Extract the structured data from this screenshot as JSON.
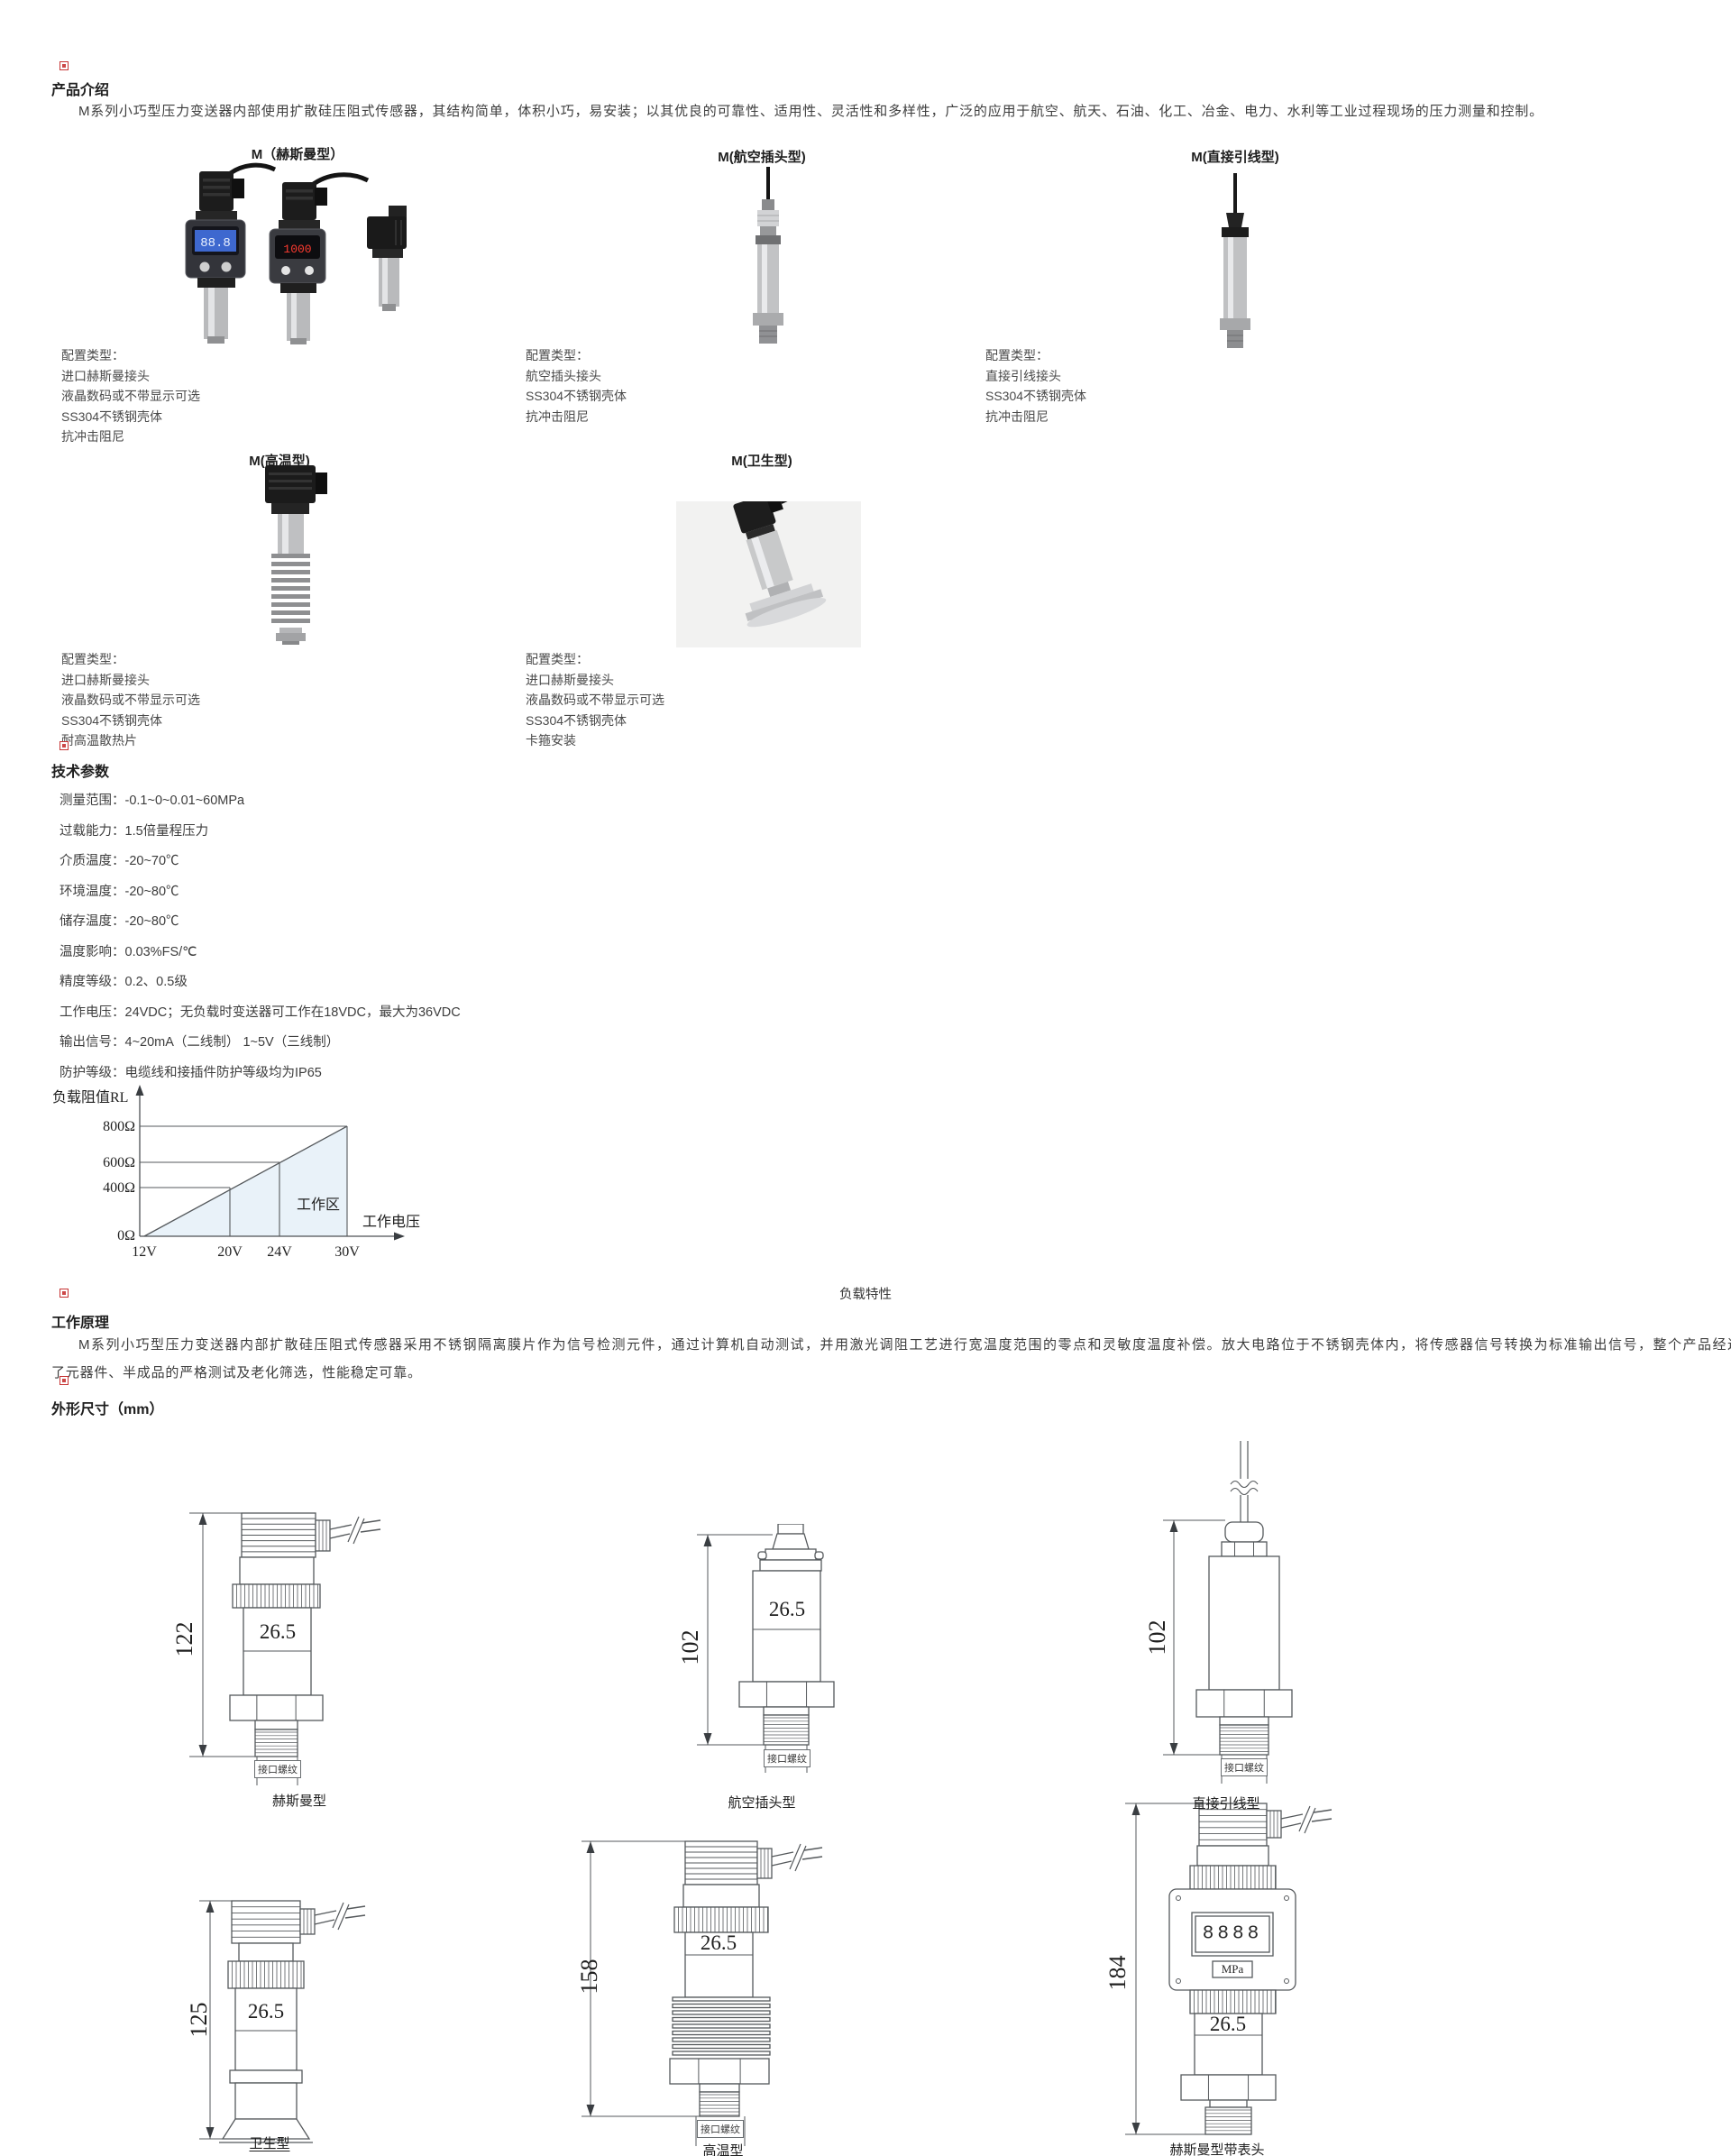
{
  "intro": {
    "header": "产品介绍",
    "text": "M系列小巧型压力变送器内部使用扩散硅压阻式传感器，其结构简单，体积小巧，易安装；以其优良的可靠性、适用性、灵活性和多样性，广泛的应用于航空、航天、石油、化工、冶金、电力、水利等工业过程现场的压力测量和控制。"
  },
  "products": [
    {
      "title": "M（赫斯曼型）",
      "config": [
        "配置类型：",
        "进口赫斯曼接头",
        "液晶数码或不带显示可选",
        "SS304不锈钢壳体",
        "抗冲击阻尼"
      ]
    },
    {
      "title": "M(航空插头型)",
      "config": [
        "配置类型：",
        "航空插头接头",
        "SS304不锈钢壳体",
        "抗冲击阻尼"
      ]
    },
    {
      "title": "M(直接引线型)",
      "config": [
        "配置类型：",
        "直接引线接头",
        "SS304不锈钢壳体",
        "抗冲击阻尼"
      ]
    },
    {
      "title": "M(高温型)",
      "config": [
        "配置类型：",
        "进口赫斯曼接头",
        "液晶数码或不带显示可选",
        "SS304不锈钢壳体",
        "耐高温散热片"
      ]
    },
    {
      "title": "M(卫生型)",
      "config": [
        "配置类型：",
        "进口赫斯曼接头",
        "液晶数码或不带显示可选",
        "SS304不锈钢壳体",
        "卡箍安装"
      ]
    }
  ],
  "photos": {
    "lcd_value": "88.8",
    "led_value": "1000"
  },
  "tech": {
    "header": "技术参数",
    "params": [
      "测量范围：-0.1~0~0.01~60MPa",
      "过载能力：1.5倍量程压力",
      "介质温度：-20~70℃",
      "环境温度：-20~80℃",
      "储存温度：-20~80℃",
      "温度影响：0.03%FS/℃",
      "精度等级：0.2、0.5级",
      "工作电压：24VDC；无负载时变送器可工作在18VDC，最大为36VDC",
      "输出信号：4~20mA（二线制）  1~5V（三线制）",
      "防护等级：电缆线和接插件防护等级均为IP65"
    ]
  },
  "chart_data": {
    "type": "line",
    "title": "负载特性",
    "caption": "负载特性",
    "ylabel": "负载阻值RL",
    "xlabel": "工作电压",
    "region_label": "工作区",
    "x_ticks": [
      "12V",
      "20V",
      "24V",
      "30V"
    ],
    "y_ticks": [
      "0Ω",
      "400Ω",
      "600Ω",
      "800Ω"
    ],
    "x_values": [
      12,
      20,
      24,
      30
    ],
    "y_values": [
      0,
      400,
      600,
      800
    ],
    "series": [
      {
        "name": "负载阻值上限线",
        "x": [
          12,
          30
        ],
        "y": [
          0,
          800
        ]
      }
    ],
    "xlim": [
      12,
      30
    ],
    "ylim": [
      0,
      800
    ],
    "grid": false,
    "legend": "none"
  },
  "principle": {
    "header": "工作原理",
    "line1": "M系列小巧型压力变送器内部扩散硅压阻式传感器采用不锈钢隔离膜片作为信号检测元件，通过计算机自动测试，并用激光调阻工艺进行宽温度范围的零点和灵敏度温度补偿。放大电路位于不锈钢壳体内，将传感器信号转换为标准输出信号，整个产品经过",
    "line2": "了元器件、半成品的严格测试及老化筛选，性能稳定可靠。"
  },
  "dimensions": {
    "header": "外形尺寸（mm）",
    "drawings": [
      {
        "label": "赫斯曼型",
        "height_dim": "122",
        "body_dim": "26.5",
        "port_label": "接口螺纹"
      },
      {
        "label": "航空插头型",
        "height_dim": "102",
        "body_dim": "26.5",
        "port_label": "接口螺纹"
      },
      {
        "label": "直接引线型",
        "height_dim": "102",
        "port_label": "接口螺纹"
      },
      {
        "label": "卫生型",
        "height_dim": "125",
        "body_dim": "26.5"
      },
      {
        "label": "高温型",
        "height_dim": "158",
        "body_dim": "26.5",
        "port_label": "接口螺纹"
      },
      {
        "label": "赫斯曼型带表头",
        "height_dim": "184",
        "body_dim": "26.5",
        "display_value": "8888",
        "display_unit": "MPa"
      }
    ]
  }
}
